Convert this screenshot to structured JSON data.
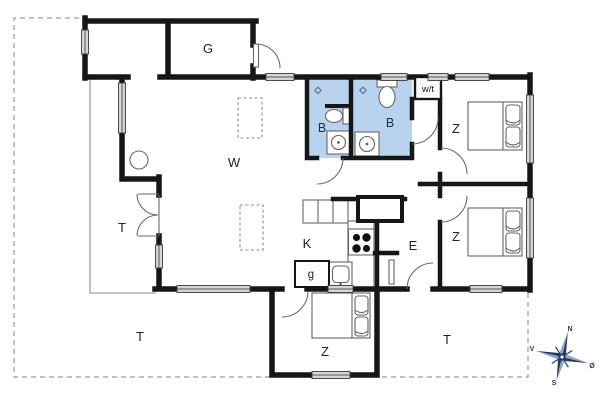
{
  "plan": {
    "type": "floor-plan",
    "labels": {
      "garage": "G",
      "living": "W",
      "kitchen": "K",
      "entry": "E",
      "utility_box": "g",
      "tech_closet": "w/t",
      "bath_small": "B",
      "bath_large": "B",
      "bedroom_ne": "Z",
      "bedroom_se": "Z",
      "bedroom_sw": "Z",
      "terrace_west": "T",
      "terrace_southwest": "T",
      "terrace_southeast": "T"
    },
    "compass": {
      "north": "N",
      "west": "V",
      "east": "Ø",
      "south": "S"
    },
    "colors": {
      "bath_fill": "#b9d3ee",
      "wall": "#161616",
      "window_fill": "#d6d6d6",
      "compass": "#233a66",
      "compass_light": "#8ea3c6",
      "boundary": "#9a9a9a"
    }
  }
}
